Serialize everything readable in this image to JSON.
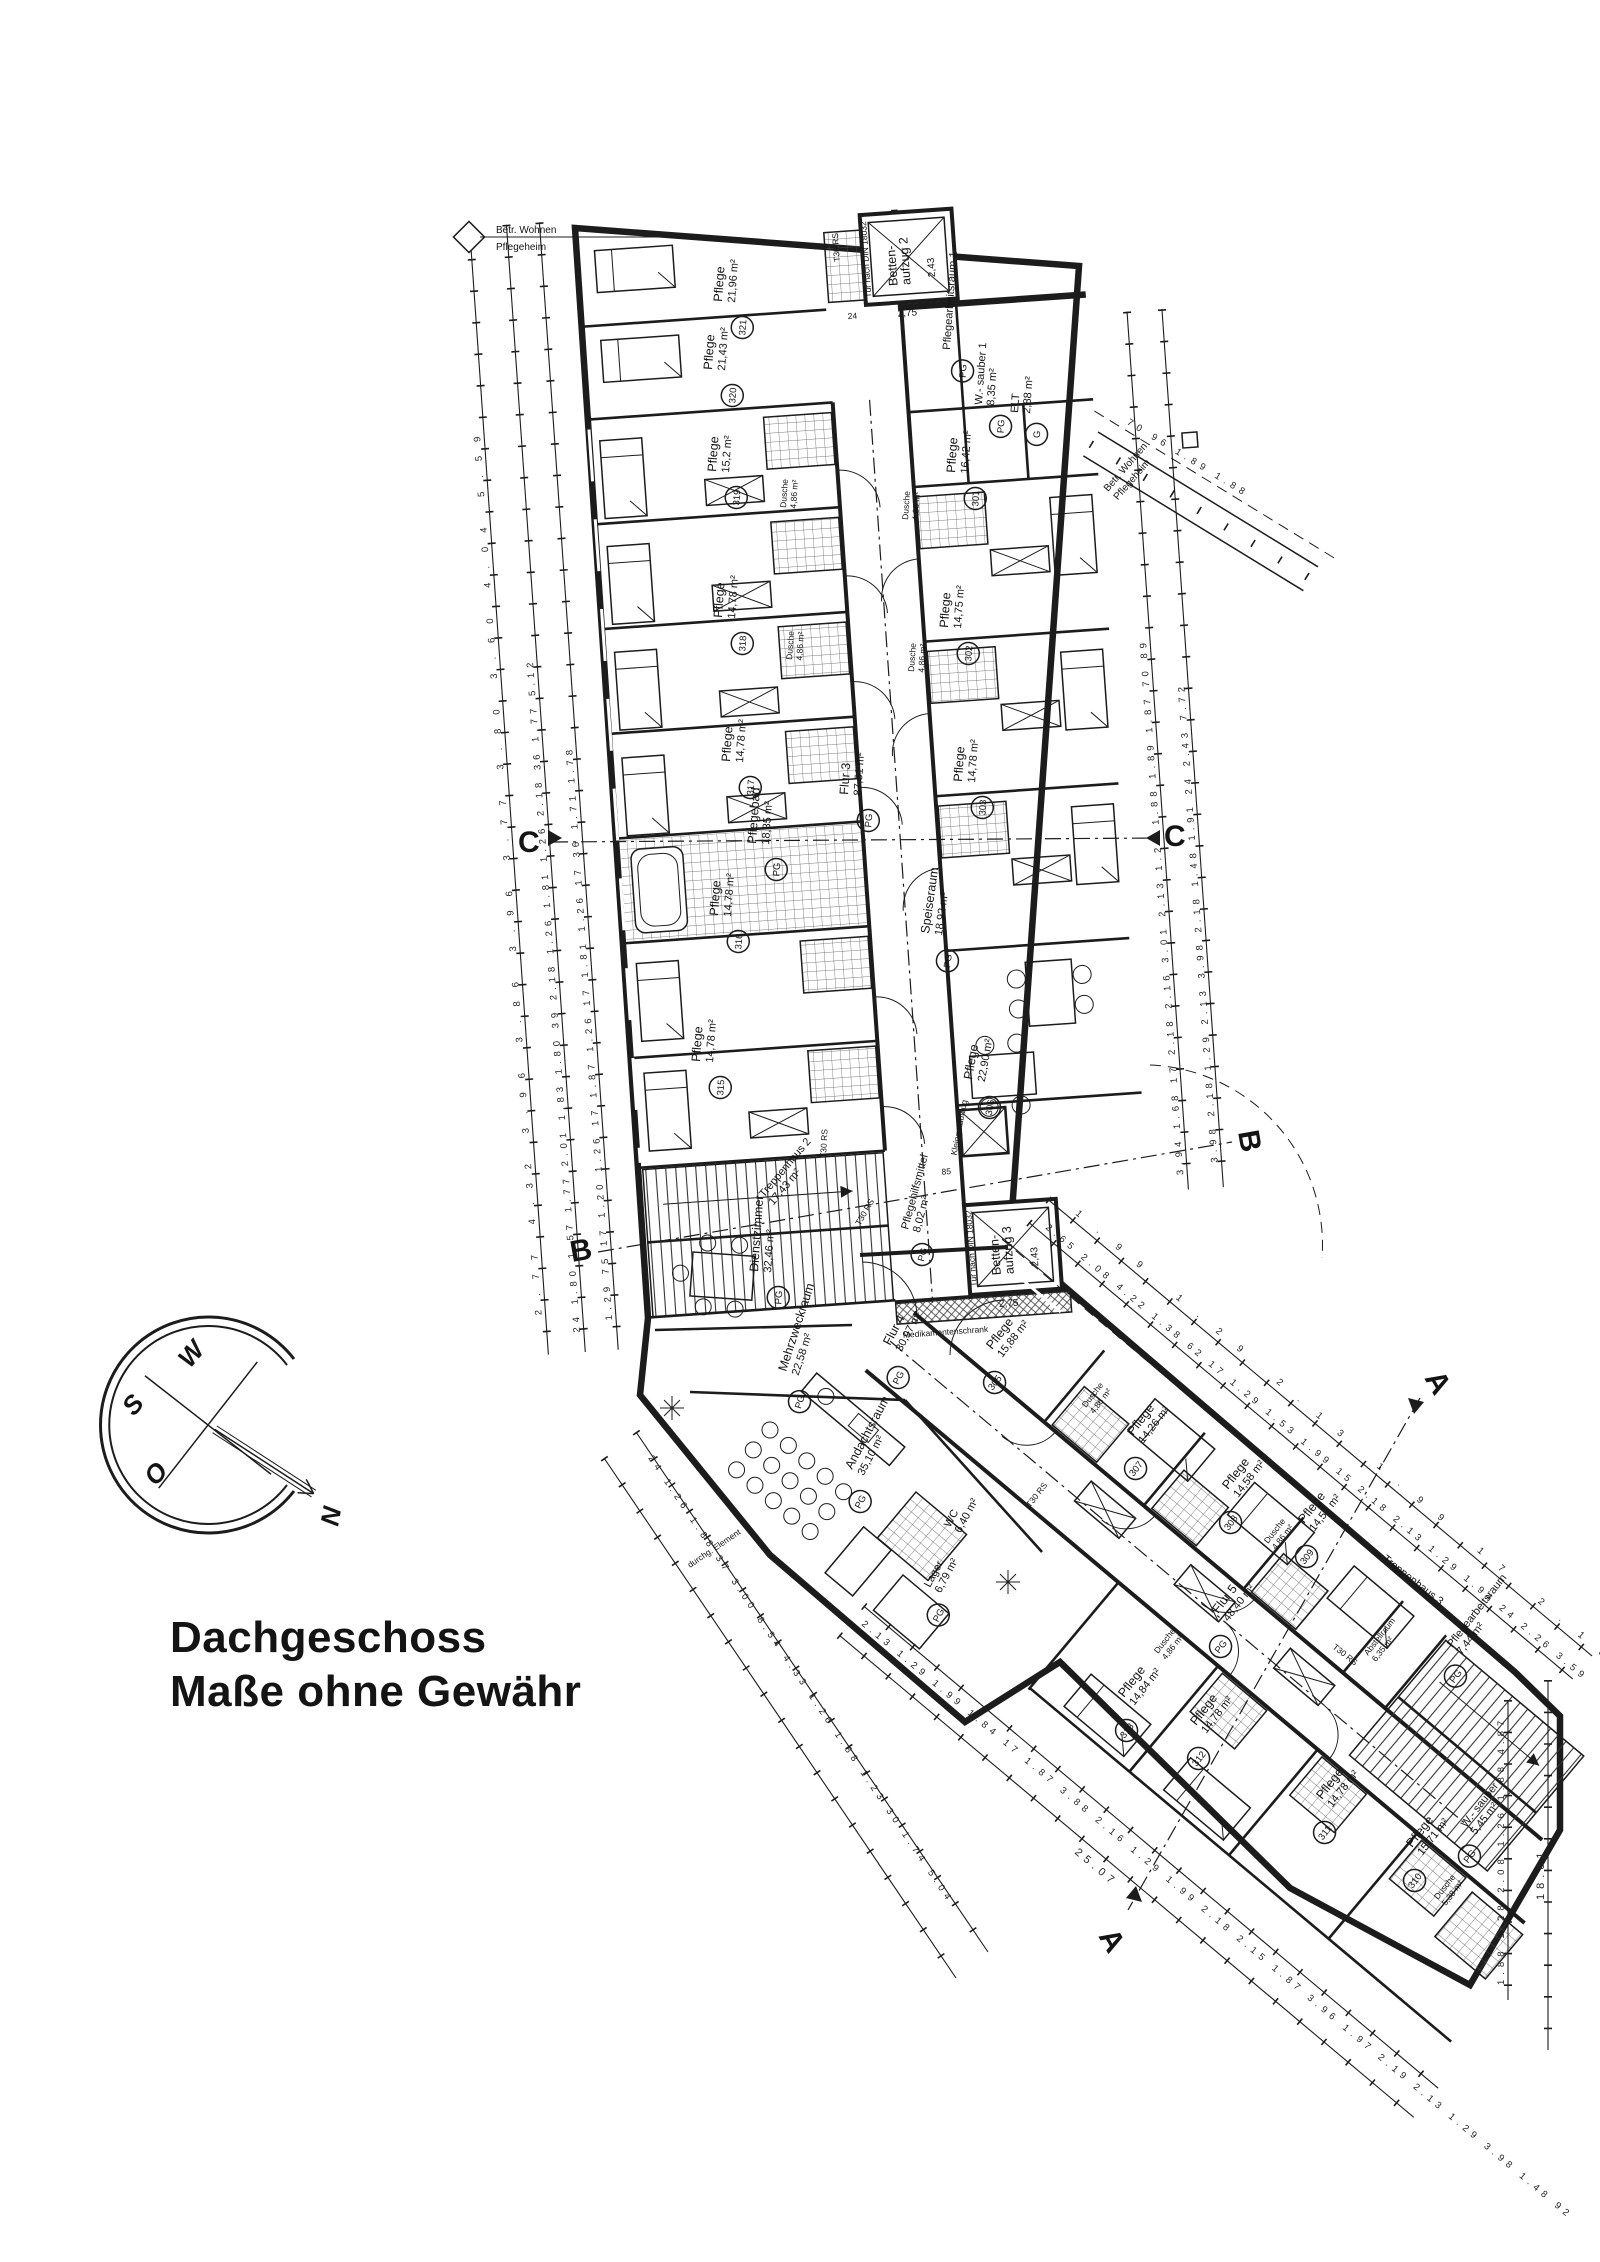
{
  "title": {
    "line1": "Dachgeschoss",
    "line2": "Maße ohne Gewähr"
  },
  "corner_label": {
    "line1": "Betr. Wohnen",
    "line2": "Pflegeheim"
  },
  "corner_label_diag": {
    "line1": "Betr. Wohnen",
    "line2": "Pflegeheim"
  },
  "compass": {
    "n": "N",
    "o": "O",
    "s": "S",
    "w": "W"
  },
  "section_markers": {
    "a": "A",
    "b": "B",
    "c": "C"
  },
  "rooms": [
    {
      "name": "Pflege",
      "area": "21,96 m²",
      "num": "321"
    },
    {
      "name": "Pflege",
      "area": "21,43 m²",
      "num": "320"
    },
    {
      "name": "Pflege",
      "area": "15,2 m²",
      "num": "319"
    },
    {
      "name": "Pflege",
      "area": "14,78 m²",
      "num": "318"
    },
    {
      "name": "Pflege",
      "area": "14,78 m²",
      "num": "317"
    },
    {
      "name": "Pflege",
      "area": "14,78 m²",
      "num": "316"
    },
    {
      "name": "Pflegebad",
      "area": "18,35 m²",
      "num": "PG"
    },
    {
      "name": "Pflege",
      "area": "14,78 m²",
      "num": "315"
    },
    {
      "name": "Pflegearbeitsraum 1",
      "area": "",
      "num": "PG"
    },
    {
      "name": "W.- sauber 1",
      "area": "8,35 m²",
      "num": "PG"
    },
    {
      "name": "ELT",
      "area": "2,88 m²",
      "num": "G"
    },
    {
      "name": "Pflege",
      "area": "16,42 m²",
      "num": "301"
    },
    {
      "name": "Pflege",
      "area": "14,75 m²",
      "num": "302"
    },
    {
      "name": "Pflege",
      "area": "14,78 m²",
      "num": "303"
    },
    {
      "name": "Speiseraum",
      "area": "18,92 m²",
      "num": "PG"
    },
    {
      "name": "Pflege",
      "area": "22,90 m²",
      "num": "306"
    },
    {
      "name": "Flur 3",
      "area": "87,51 m²",
      "num": "PG"
    },
    {
      "name": "Pflegehilfsmittel",
      "area": "8,02 m²",
      "num": "PG"
    },
    {
      "name": "Treppenhaus 2",
      "area": "17,43 m²",
      "num": "PG"
    },
    {
      "name": "Dienstzimmer",
      "area": "32,46 m²",
      "num": "PG"
    },
    {
      "name": "Mehrzweckraum",
      "area": "22,58 m²",
      "num": "PG"
    },
    {
      "name": "Flur 4",
      "area": "30,97 m²",
      "num": "PG"
    },
    {
      "name": "Andachtsraum",
      "area": "35,10 m²",
      "num": "PG"
    },
    {
      "name": "Lager",
      "area": "6,79 m²",
      "num": "PG"
    },
    {
      "name": "WC",
      "area": "6,40 m²",
      "num": ""
    },
    {
      "name": "Pflege",
      "area": "15,88 m²",
      "num": "305"
    },
    {
      "name": "Pflege",
      "area": "14,26 m²",
      "num": "307"
    },
    {
      "name": "Pflege",
      "area": "14,58 m²",
      "num": "308"
    },
    {
      "name": "Pflege",
      "area": "14,57 m²",
      "num": "309"
    },
    {
      "name": "Flur 5",
      "area": "48,40 m²",
      "num": "PG"
    },
    {
      "name": "Pflege",
      "area": "14,84 m²",
      "num": "313"
    },
    {
      "name": "Pflege",
      "area": "14,78 m²",
      "num": "312"
    },
    {
      "name": "Pflege",
      "area": "14,78 m²",
      "num": "311"
    },
    {
      "name": "Pflege",
      "area": "15,71 m²",
      "num": "310"
    },
    {
      "name": "W.- sauber",
      "area": "5,45 m²",
      "num": "PG"
    },
    {
      "name": "Pflegearbeitsraum",
      "area": "7,44 m²",
      "num": "PG"
    },
    {
      "name": "Treppenhaus 3",
      "area": "",
      "num": ""
    },
    {
      "name": "Abstellraum",
      "area": "6,35 m²",
      "num": ""
    }
  ],
  "labels": {
    "dusche": "Dusche",
    "dusche_area": "4,86 m²",
    "dusche_area_large": "5,38 m²",
    "t30": "T30 RS",
    "medikamentenschrank": "Medikamentenschrank",
    "durchg_element": "durchg. Element"
  },
  "elevators": {
    "b2_line1": "Betten-",
    "b2_line2": "aufzug 2",
    "b3_line1": "Betten-",
    "b3_line2": "aufzug 3",
    "width": "2,43",
    "depth": "2,75",
    "door_note": "Tür nach DIN 18032",
    "sill": "24",
    "kleingut": "Kleingutaufzug",
    "kleingut_dim": "85"
  },
  "dims": {
    "left_outer": "2.77 4.32 3.96 3.86 3.96 3.77 3.80 3.60 4.04 5.59",
    "left_mid": "24 1.80 1.57 1.77 2.01 1.83 1.80 39 2.18 1.26 1.81 1.26 2.18 36 1.77 5.12",
    "left_inner": "1.29 75 17 1.20 1.26 17 1.87 1.26 17 1.81 1.26 17 36 1.71 1.78",
    "right_inner": "3.94 1.68 17 2.18 2.16 3.01 2.13 1.29 1.88 1.89 1.87 70 89",
    "right_outer": "3.98 2.18 1.29 2.13 3.98 2.18 1.48 1.91 24 2.43 7.72",
    "wing2_ne": "2.65 2.08 4.22 1.38 62 17 1.29 1.53 1.99 15 2.18 2.13 1.29 1.94 24 2.26 3.59",
    "wing2_ne2": "1.99 1.29 2.13 1.99 17 2.18",
    "wing2_sw_inner": "2.13 1.29 1.99 1.84 17 1.87 3.88 2.16 1.29 1.99 2.18 2.15 1.87 3.96 1.97 2.19 2.13 1.29 3.98 1.48 92",
    "wing2_sw_outer": "25.07",
    "far_right": "1.88 1.28 2.08 1.26 1.88 4.87",
    "far_right_total": "18.61",
    "junction_sw": "24 1.26 1.88 37 3.00 8.54 4.33 1.26 1.88 1.23 30 1.74 5.04",
    "ramp": "70 96 1.89 1.88"
  },
  "colors": {
    "ink": "#1c1c1c",
    "paper": "#ffffff"
  }
}
